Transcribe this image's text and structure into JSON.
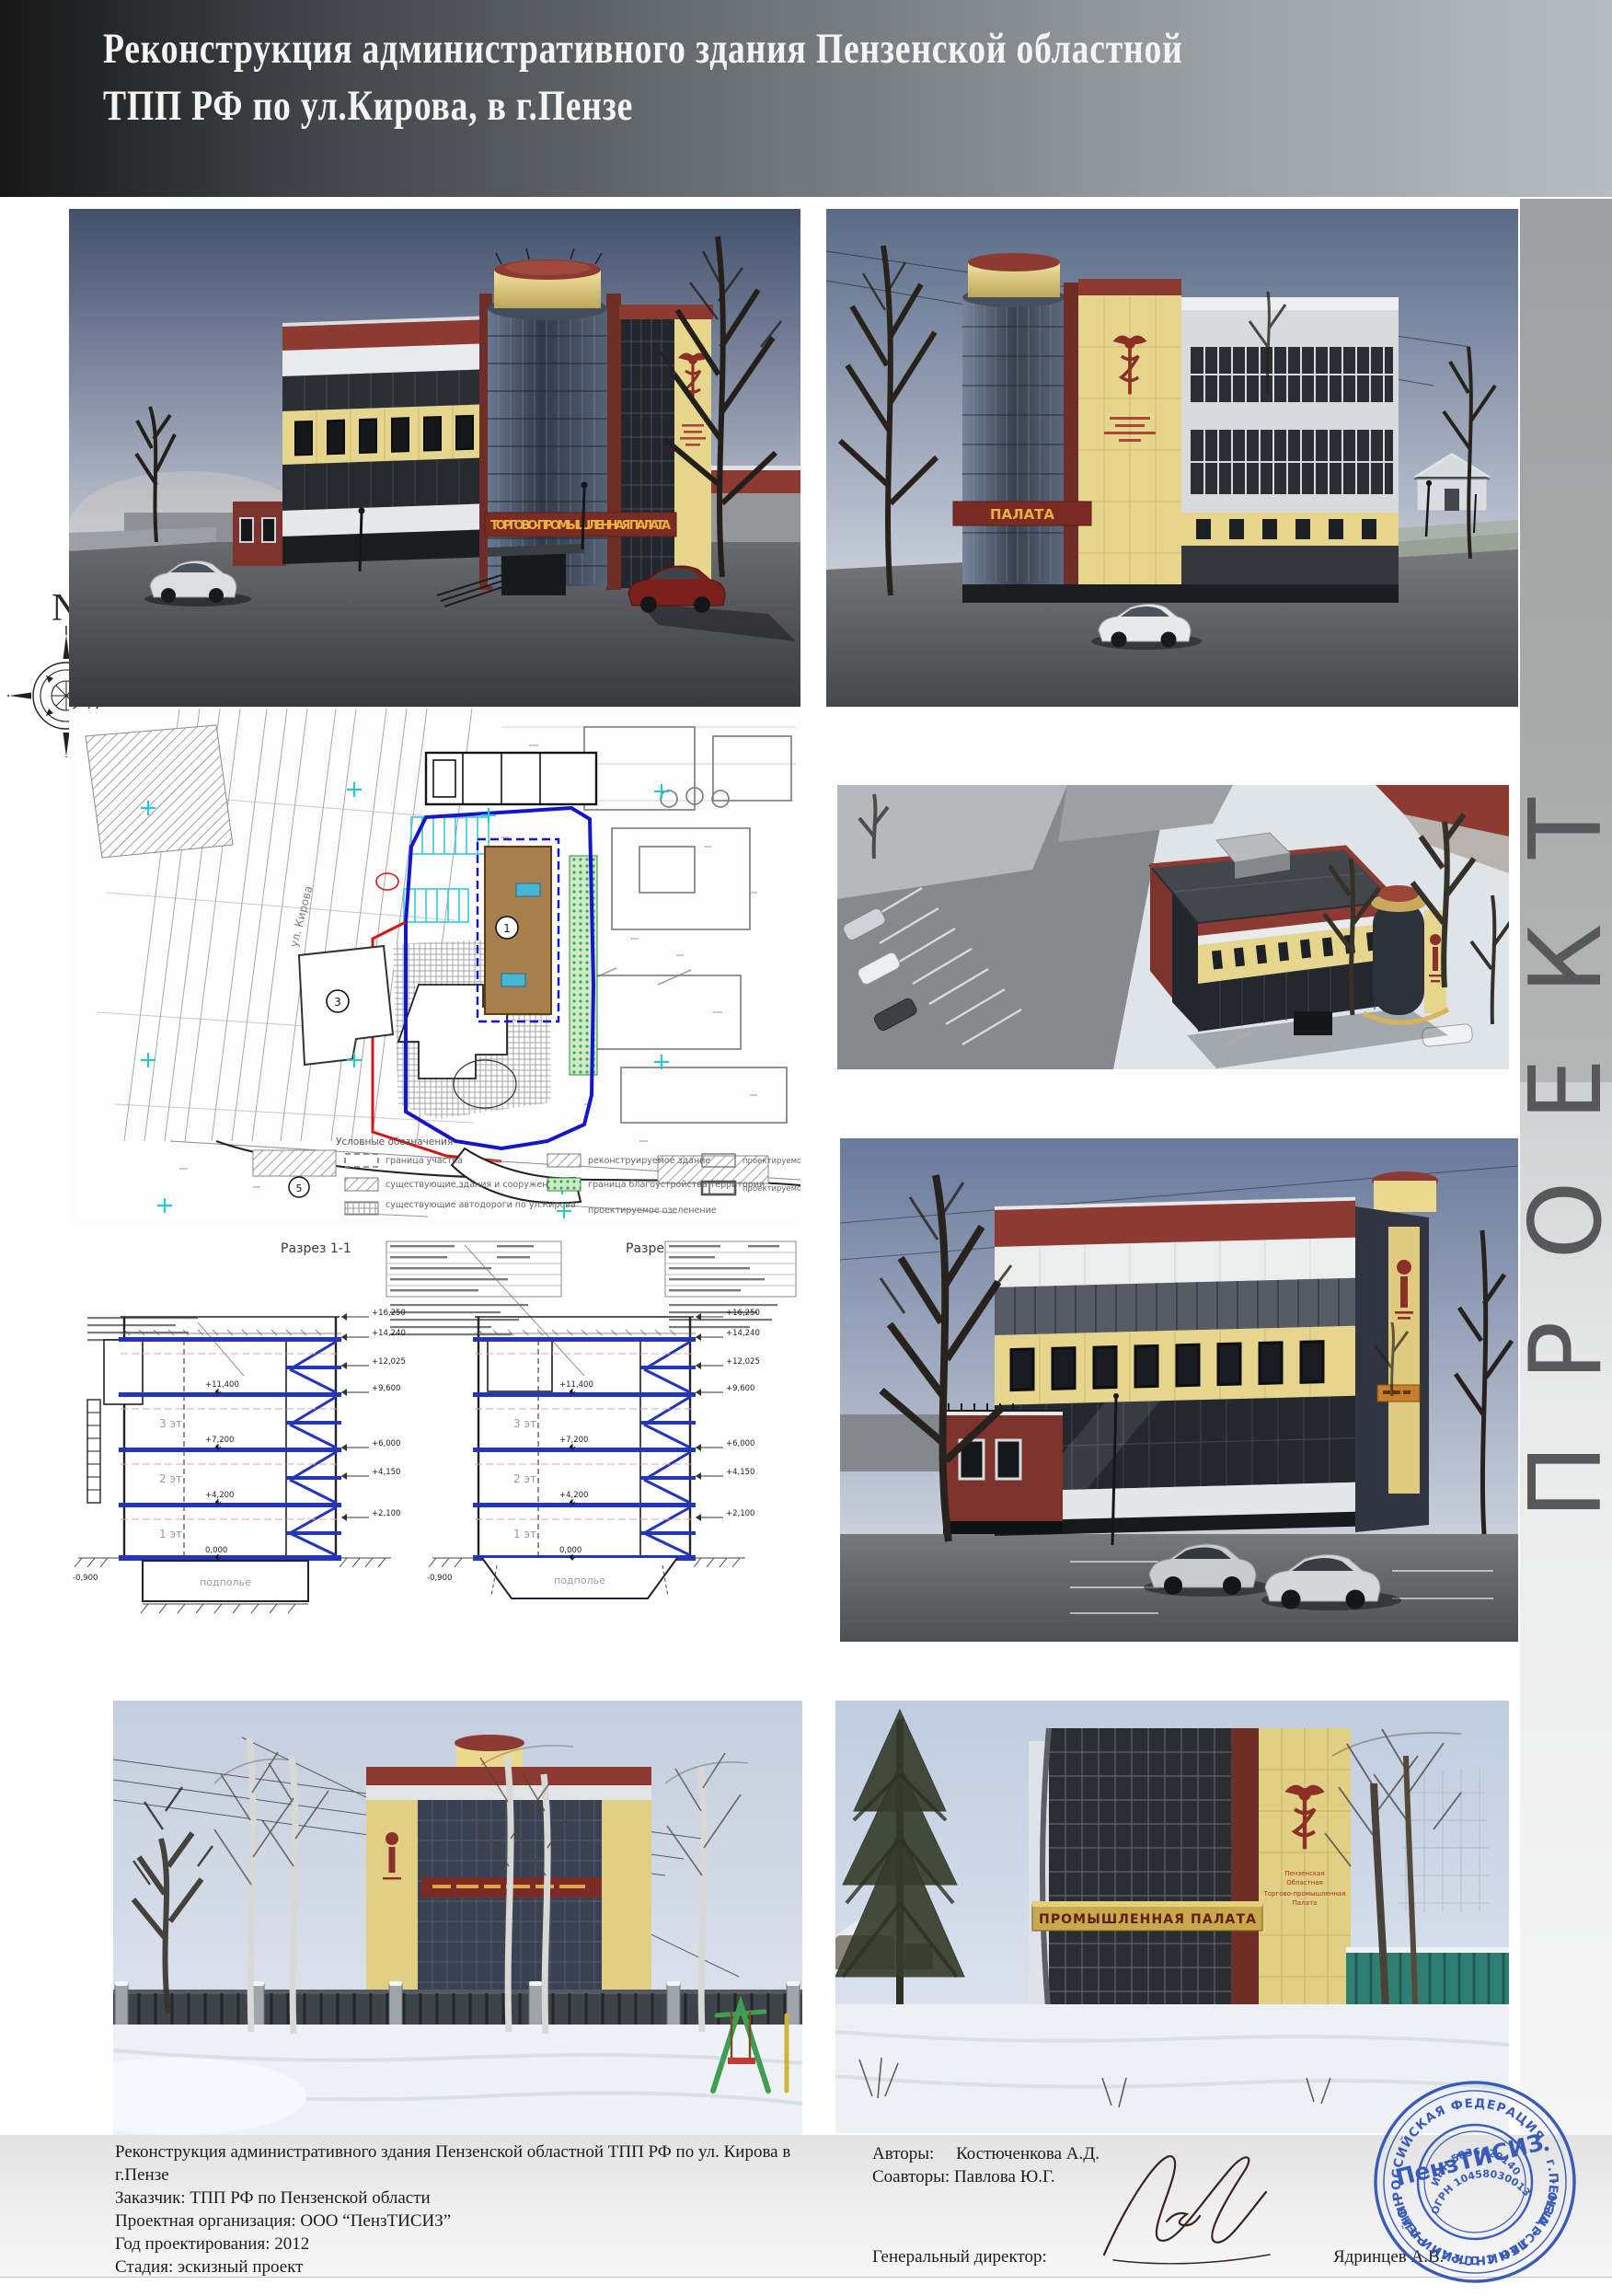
{
  "header": {
    "title_line1": "Реконструкция административного здания Пензенской областной",
    "title_line2": "ТПП РФ по ул.Кирова,  в г.Пензе"
  },
  "compass": {
    "label": "N"
  },
  "proekt": {
    "word": "ПРОЕКТ",
    "letters": [
      "Т",
      "К",
      "Е",
      "О",
      "Р",
      "П"
    ]
  },
  "signs": {
    "front": "ТОРГОВО-ПРОМЫШЛЕННАЯ ПАЛАТА",
    "back": "ПАЛАТА",
    "photo_right": "ПРОМЫШЛЕННАЯ  ПАЛАТА",
    "emblem": [
      "Пензенская",
      "Областная",
      "Торгово-промышленная",
      "Палата"
    ]
  },
  "site_plan": {
    "street": "ул. Кирова",
    "legend_title": "Условные обозначения",
    "marks": {
      "b1": "1",
      "b3": "3",
      "b5": "5"
    },
    "legend": [
      {
        "label": "граница участка"
      },
      {
        "label": "существующие здания и сооружения"
      },
      {
        "label": "существующие автодороги по ул.Кирова"
      },
      {
        "label": "реконструируемое здание"
      },
      {
        "label": "граница благоустройства территории"
      },
      {
        "label": "проектируемое озеленение"
      },
      {
        "label": "проектируемое основание"
      },
      {
        "label": "проектируемое здание"
      }
    ]
  },
  "sections": {
    "s1_title": "Разрез 1-1",
    "s2_title": "Разрез 2-2",
    "floors": [
      "3 эт",
      "2 эт",
      "1 эт"
    ],
    "basement": "подполье",
    "levels_right": [
      "+16,250",
      "+14,240",
      "+12,025",
      "+9,600",
      "+6,000",
      "+4,150",
      "+2,100"
    ],
    "levels_inner": [
      "+11,400",
      "+7,200",
      "+4,200",
      "0,000",
      "-0,900"
    ]
  },
  "footer": {
    "left_lines": [
      "Реконструкция административного здания Пензенской областной ТПП РФ по ул. Кирова в",
      "г.Пензе",
      "Заказчик: ТПП РФ по Пензенской области",
      "Проектная организация: ООО “ПензТИСИЗ”",
      "Год проектирования: 2012",
      "Стадия: эскизный проект"
    ],
    "authors_label": "Авторы:",
    "authors_name": "Костюченкова А.Д.",
    "coauthors": "Соавторы: Павлова Ю.Г.",
    "director_label": "Генеральный директор:",
    "director_name": "Ядринцев А.В."
  },
  "stamp": {
    "center": "ПензТИСИЗ",
    "outer_top": "РОССИЙСКАЯ ФЕДЕРАЦИЯ • г.ПЕНЗА • ЛЕНИНСКИЙ РАЙОН",
    "outer_bottom": "• ОБЩЕСТВО С ОГРАНИЧЕННОЙ ОТВЕТСТВЕННОСТЬЮ •",
    "inn": "ИНН 5836620140",
    "ogrn": "ОГРН 1045803001386"
  },
  "colors": {
    "accent_red": "#8c3a32",
    "facade_yellow": "#e6d58c",
    "stamp_blue": "#2b4fb4",
    "plan_blue": "#1515cc",
    "plan_red": "#d01818",
    "plan_green": "#3fae3f"
  }
}
